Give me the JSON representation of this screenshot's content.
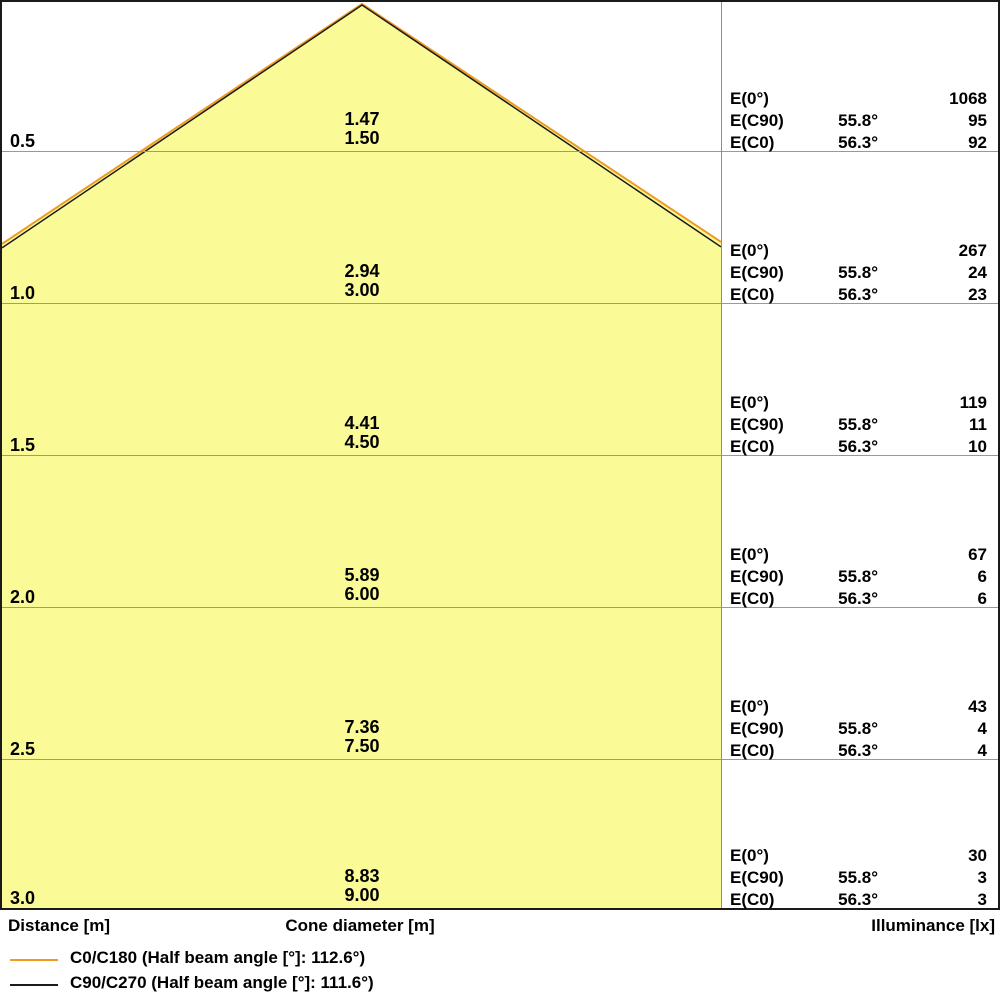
{
  "colors": {
    "cone_fill": "#FAFA96",
    "c0_c180": "#EE9B20",
    "c90_c270": "#1A1A1A",
    "grid": "#999999",
    "divider": "#8C8C8C",
    "border": "#1A1A1A"
  },
  "axis": {
    "distance_label": "Distance [m]",
    "cone_diameter_label": "Cone diameter [m]",
    "illuminance_label": "Illuminance [lx]"
  },
  "table_labels": {
    "e0": "E(0°)",
    "ec90": "E(C90)",
    "ec0": "E(C0)"
  },
  "rows": [
    {
      "distance": "0.5",
      "cone_c90": "1.47",
      "cone_c0": "1.50",
      "illu_e0": "1068",
      "angle_c90": "55.8°",
      "illu_ec90": "95",
      "angle_c0": "56.3°",
      "illu_ec0": "92"
    },
    {
      "distance": "1.0",
      "cone_c90": "2.94",
      "cone_c0": "3.00",
      "illu_e0": "267",
      "angle_c90": "55.8°",
      "illu_ec90": "24",
      "angle_c0": "56.3°",
      "illu_ec0": "23"
    },
    {
      "distance": "1.5",
      "cone_c90": "4.41",
      "cone_c0": "4.50",
      "illu_e0": "119",
      "angle_c90": "55.8°",
      "illu_ec90": "11",
      "angle_c0": "56.3°",
      "illu_ec0": "10"
    },
    {
      "distance": "2.0",
      "cone_c90": "5.89",
      "cone_c0": "6.00",
      "illu_e0": "67",
      "angle_c90": "55.8°",
      "illu_ec90": "6",
      "angle_c0": "56.3°",
      "illu_ec0": "6"
    },
    {
      "distance": "2.5",
      "cone_c90": "7.36",
      "cone_c0": "7.50",
      "illu_e0": "43",
      "angle_c90": "55.8°",
      "illu_ec90": "4",
      "angle_c0": "56.3°",
      "illu_ec0": "4"
    },
    {
      "distance": "3.0",
      "cone_c90": "8.83",
      "cone_c0": "9.00",
      "illu_e0": "30",
      "angle_c90": "55.8°",
      "illu_ec90": "3",
      "angle_c0": "56.3°",
      "illu_ec0": "3"
    }
  ],
  "legend": [
    {
      "label": "C0/C180 (Half beam angle [°]: 112.6°)",
      "color": "#EE9B20"
    },
    {
      "label": "C90/C270 (Half beam angle [°]: 111.6°)",
      "color": "#1A1A1A"
    }
  ],
  "chart_data": {
    "type": "area",
    "title": "Light cone diagram",
    "xlabel": "Distance [m]",
    "ylabel_mid": "Cone diameter [m]",
    "ylabel_right": "Illuminance [lx]",
    "distances_m": [
      0.5,
      1.0,
      1.5,
      2.0,
      2.5,
      3.0
    ],
    "series": [
      {
        "name": "C0/C180",
        "half_beam_angle_deg": 112.6,
        "half_angle_deg": 56.3,
        "cone_diameter_m": [
          1.5,
          3.0,
          4.5,
          6.0,
          7.5,
          9.0
        ],
        "illuminance_ec0_lx": [
          92,
          23,
          10,
          6,
          4,
          3
        ],
        "color": "#EE9B20"
      },
      {
        "name": "C90/C270",
        "half_beam_angle_deg": 111.6,
        "half_angle_deg": 55.8,
        "cone_diameter_m": [
          1.47,
          2.94,
          4.41,
          5.89,
          7.36,
          8.83
        ],
        "illuminance_ec90_lx": [
          95,
          24,
          11,
          6,
          4,
          3
        ],
        "color": "#1A1A1A"
      }
    ],
    "e0_lx": [
      1068,
      267,
      119,
      67,
      43,
      30
    ],
    "legend_position": "bottom-left",
    "grid": true
  }
}
